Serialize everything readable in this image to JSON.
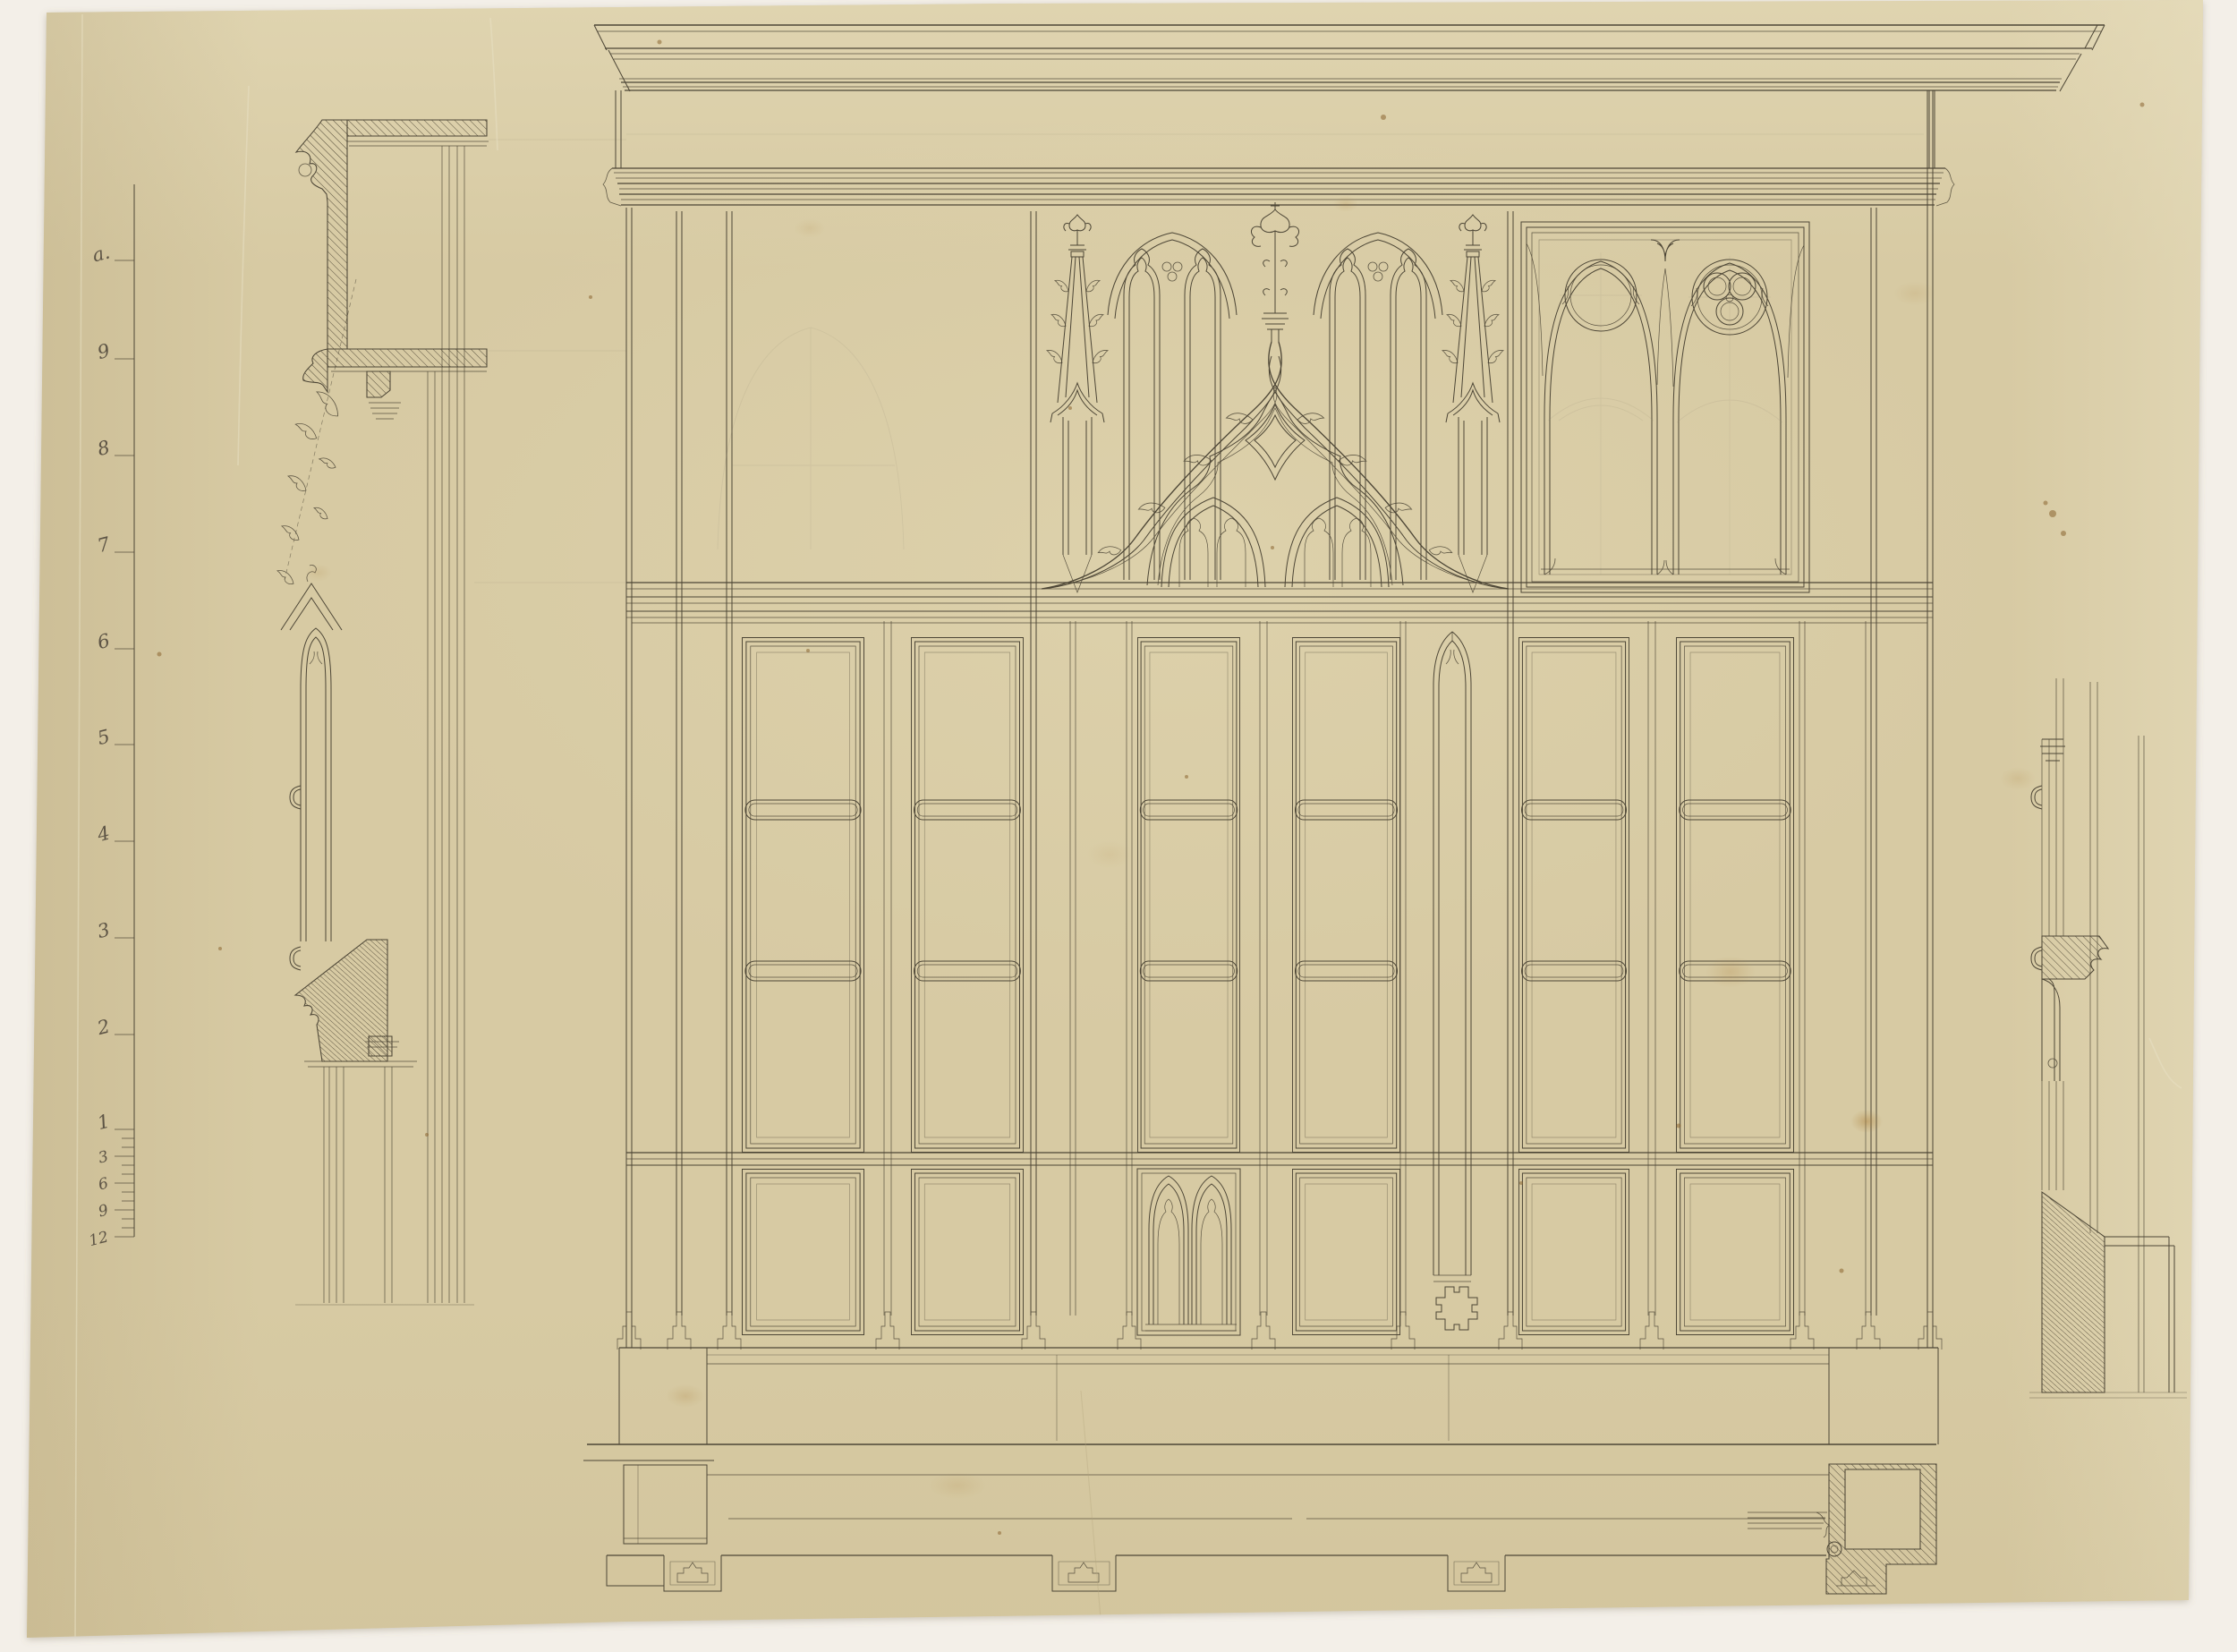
{
  "palette": {
    "mat": "#f3efe8",
    "paper": "#d7caa3",
    "ink": "#4d4636",
    "pencil": "#8e8571",
    "stain": "#a87c3c"
  },
  "ruler": {
    "feet": [
      "a.",
      "9",
      "8",
      "7",
      "6",
      "5",
      "4",
      "3",
      "2",
      "1"
    ],
    "inches": [
      "3",
      "6",
      "9",
      "12"
    ]
  }
}
